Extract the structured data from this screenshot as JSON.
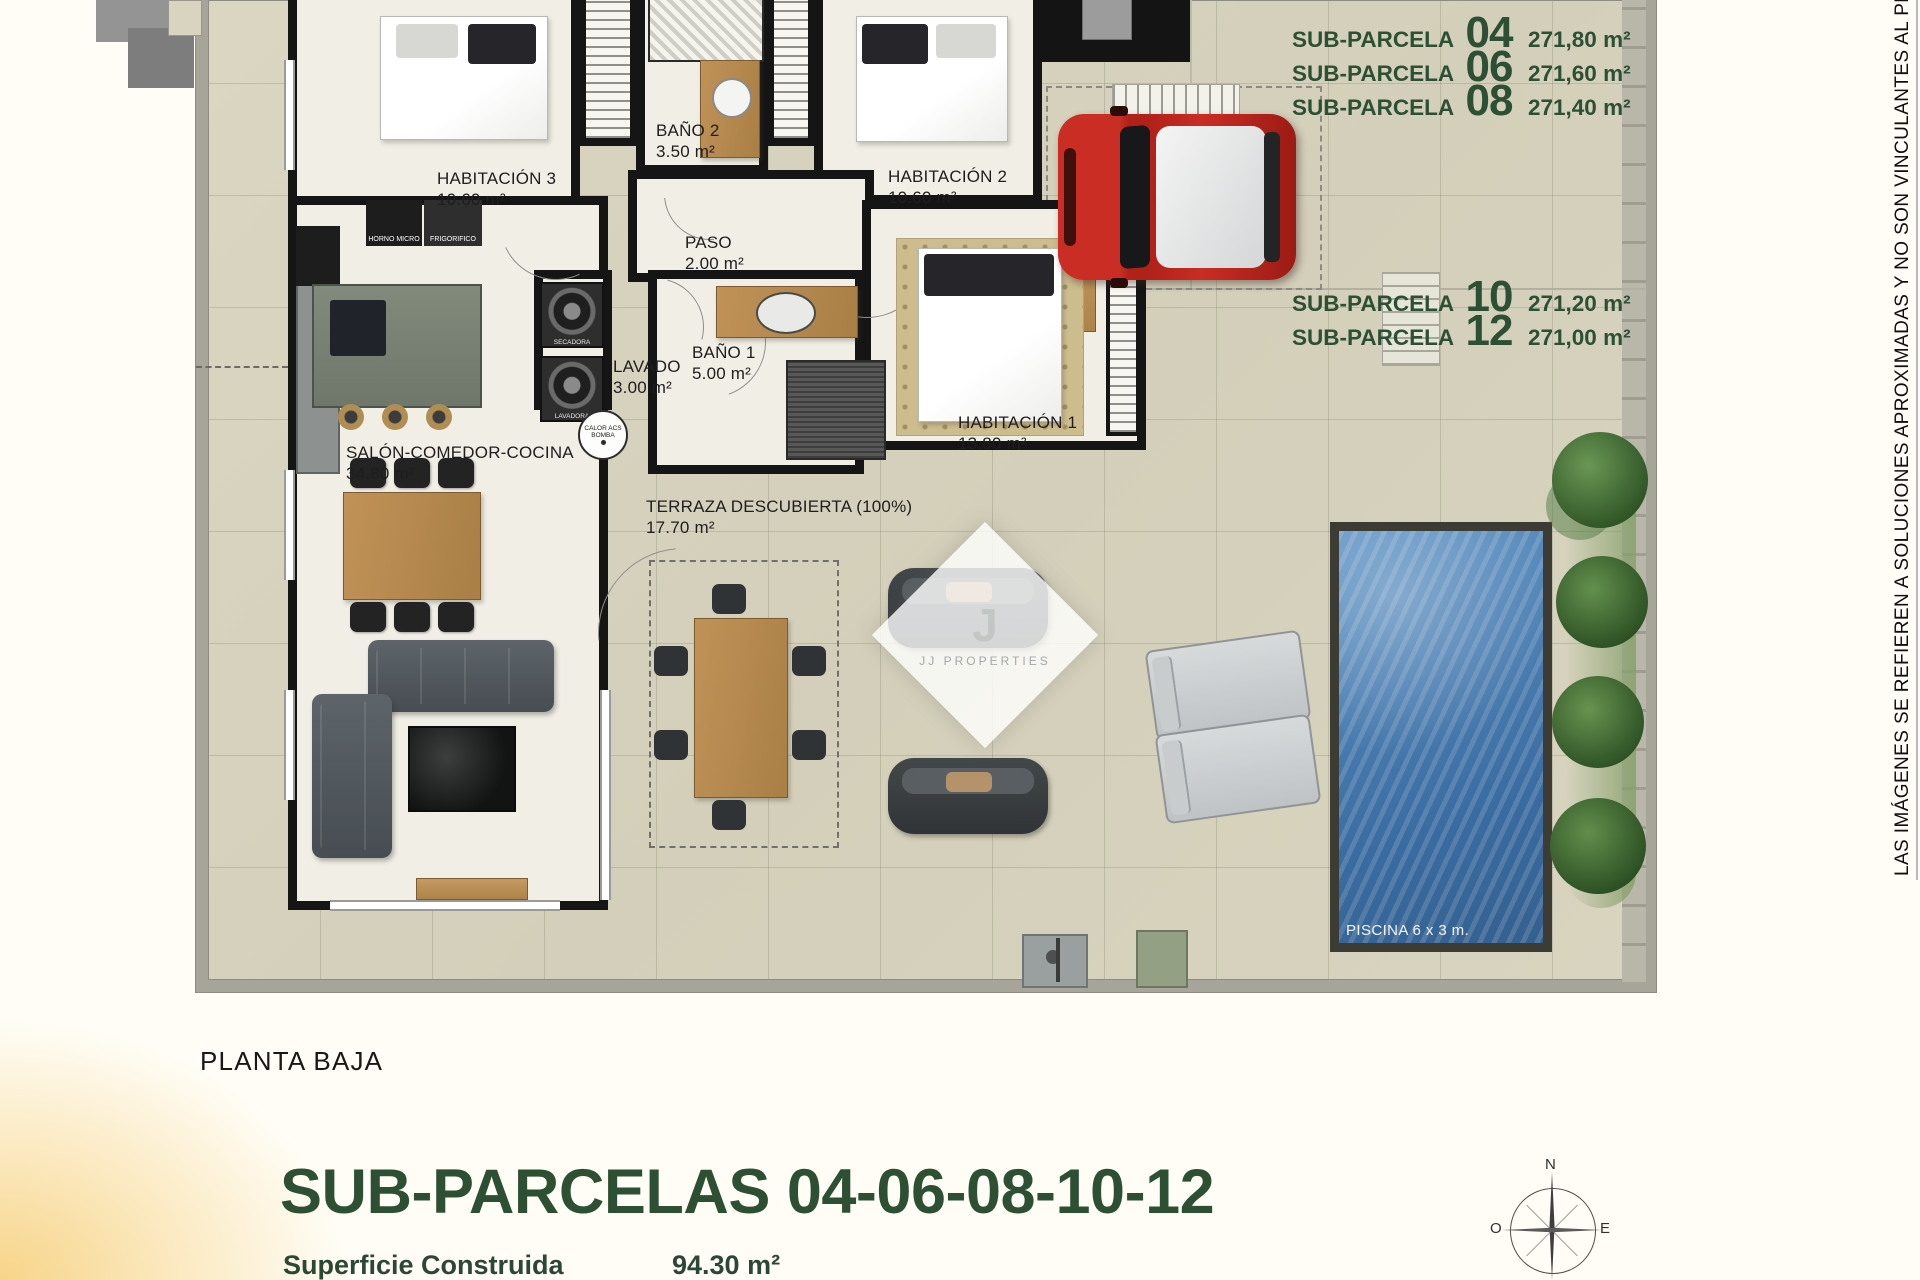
{
  "titles": {
    "floor": "PLANTA BAJA",
    "heading": "SUB-PARCELAS 04-06-08-10-12",
    "area_label": "Superficie Construida",
    "area_value": "94.30 m²"
  },
  "disclaimer": "LAS IMÁGENES SE REFIEREN A SOLUCIONES APROXIMADAS Y NO SON VINCULANTES AL PROYECT",
  "subparcelas_top": [
    {
      "label": "SUB-PARCELA",
      "number": "04",
      "area": "271,80 m²"
    },
    {
      "label": "SUB-PARCELA",
      "number": "06",
      "area": "271,60 m²"
    },
    {
      "label": "SUB-PARCELA",
      "number": "08",
      "area": "271,40 m²"
    }
  ],
  "subparcelas_bottom": [
    {
      "label": "SUB-PARCELA",
      "number": "10",
      "area": "271,20 m²"
    },
    {
      "label": "SUB-PARCELA",
      "number": "12",
      "area": "271,00 m²"
    }
  ],
  "rooms": {
    "habitacion3": {
      "name": "HABITACIÓN 3",
      "area": "10.60 m²"
    },
    "bano2": {
      "name": "BAÑO 2",
      "area": "3.50 m²"
    },
    "habitacion2": {
      "name": "HABITACIÓN 2",
      "area": "10.60 m²"
    },
    "paso": {
      "name": "PASO",
      "area": "2.00 m²"
    },
    "lavado": {
      "name": "LAVADO",
      "area": "3.00 m²"
    },
    "bano1": {
      "name": "BAÑO 1",
      "area": "5.00 m²"
    },
    "habitacion1": {
      "name": "HABITACIÓN 1",
      "area": "13.80 m²"
    },
    "salon": {
      "name": "SALÓN-COMEDOR-COCINA",
      "area": "34.80 m²"
    },
    "terraza": {
      "name": "TERRAZA DESCUBIERTA (100%)",
      "area": "17.70 m²"
    }
  },
  "pool_label": "PISCINA 6 x 3 m.",
  "appliances": {
    "horno": "HORNO MICRO",
    "frigo": "FRIGORIFICO",
    "secadora": "SECADORA",
    "lavadora": "LAVADORA",
    "calor1": "CALOR ACS",
    "calor2": "BOMBA"
  },
  "watermark": {
    "initial": "J",
    "name": "JJ PROPERTIES"
  },
  "compass": {
    "n": "N",
    "o": "O",
    "e": "E"
  },
  "colors": {
    "accent_green": "#2d4f33"
  }
}
